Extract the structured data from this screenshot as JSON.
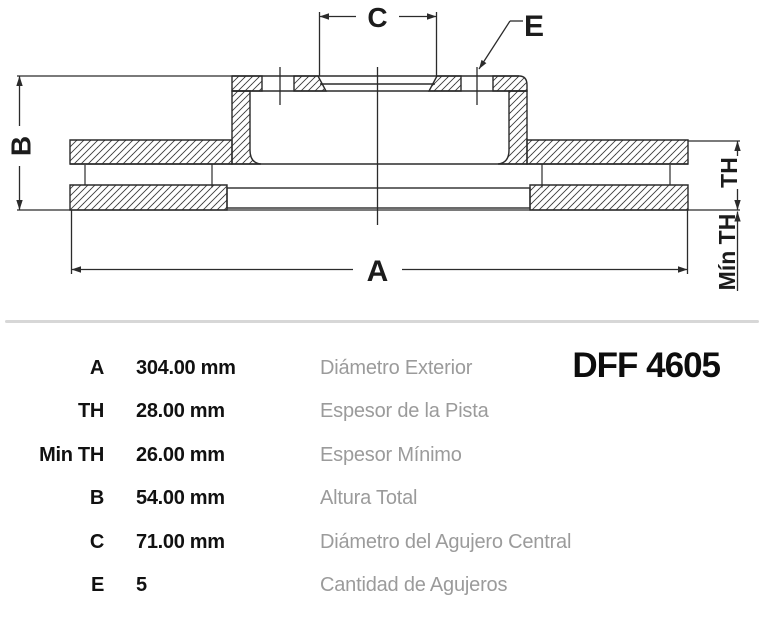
{
  "part_number": "DFF 4605",
  "drawing": {
    "labels": {
      "A": "A",
      "B": "B",
      "C": "C",
      "E": "E",
      "TH": "TH",
      "MIN_TH": "Mín TH"
    }
  },
  "specs": {
    "rows": [
      {
        "key": "A",
        "value": "304.00 mm",
        "description": "Diámetro Exterior"
      },
      {
        "key": "TH",
        "value": "28.00 mm",
        "description": "Espesor de la Pista"
      },
      {
        "key": "Min TH",
        "value": "26.00 mm",
        "description": "Espesor Mínimo"
      },
      {
        "key": "B",
        "value": "54.00 mm",
        "description": "Altura Total"
      },
      {
        "key": "C",
        "value": "71.00 mm",
        "description": "Diámetro del Agujero Central"
      },
      {
        "key": "E",
        "value": "5",
        "description": "Cantidad de Agujeros"
      }
    ]
  },
  "colors": {
    "line": "#2b2b2b",
    "hatch": "#3a3a3a",
    "divider": "#d7d7d7",
    "muted_text": "#9b9b9b",
    "text": "#111111"
  }
}
